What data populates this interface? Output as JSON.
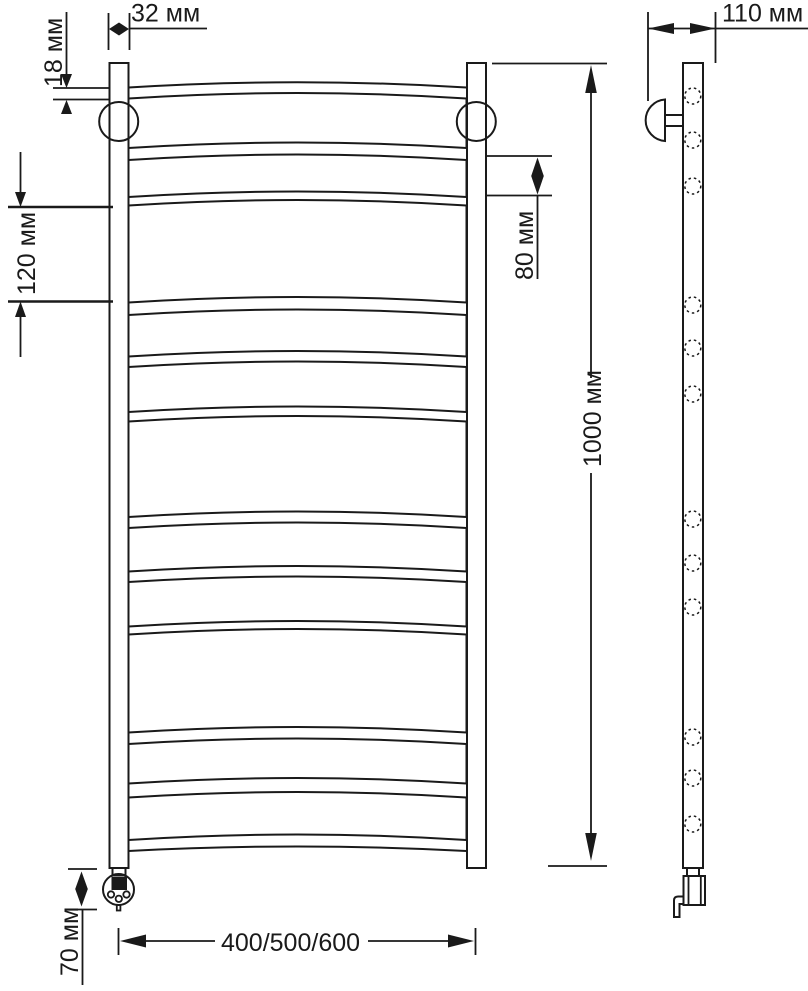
{
  "labels": {
    "tube_width": "32 мм",
    "collar_offset": "18 мм",
    "section_pitch": "120 мм",
    "rung_gap": "80 мм",
    "total_height": "1000 мм",
    "wall_depth": "110 мм",
    "element_height": "70 мм",
    "model_widths": "400/500/600"
  },
  "style": {
    "line_color": "#1a1a1a",
    "background": "#ffffff"
  }
}
